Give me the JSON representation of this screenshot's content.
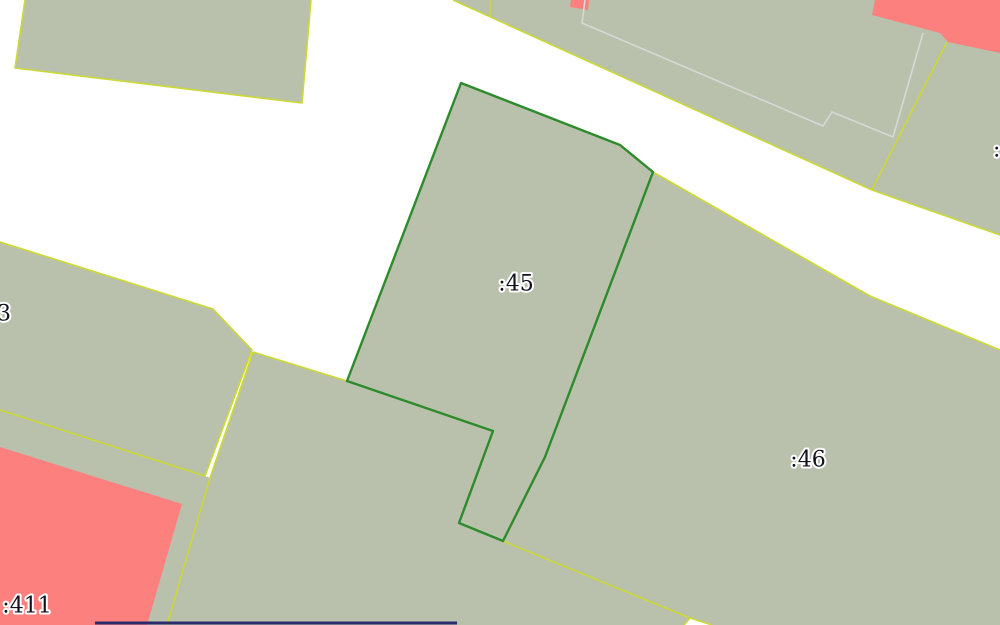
{
  "map": {
    "title": "cadastral-parcel-map",
    "colors": {
      "background": "#ffffff",
      "parcel_fill": "#b9c1ac",
      "boundary_yellow": "#ccd934",
      "selected_green": "#2e8b2c",
      "building_red": "#fc807e",
      "building_outline_gray": "#d8d8d6",
      "navy_line": "#2b2b6e",
      "label_text": "#12121c",
      "label_halo": "#ffffff"
    },
    "parcels": [
      {
        "id": "parcel-top-left",
        "points": "25,0 311,0 302,103 15,68"
      },
      {
        "id": "parcel-top-sliver",
        "points": "453,0 490,0 490,17"
      },
      {
        "id": "parcel-top-center",
        "points": "490,0 938,0 947,42 872,190 490,17"
      },
      {
        "id": "parcel-top-right",
        "points": "938,0 1000,0 1000,235 872,190 947,42"
      },
      {
        "id": "parcel-3",
        "points": "0,242 213,309 252,350 205,476 0,410"
      },
      {
        "id": "parcel-411",
        "points": "0,410 205,476 210,478 167,625 0,625"
      },
      {
        "id": "parcel-bottom-center",
        "points": "253,352 347,381 493,431 459,523 503,541 690,618 684,625 167,625 210,478"
      },
      {
        "id": "parcel-46",
        "points": "653,172 870,296 1000,350 1000,625 712,625 690,618 503,541 545,457"
      }
    ],
    "selected_parcel": {
      "id": "parcel-45",
      "points": "461,83 620,145 653,172 545,457 503,541 459,523 493,431 347,381",
      "stroke_width": 2.4
    },
    "boundaries": [
      {
        "id": "boundary-top-left-parcel",
        "points": "25,0 15,68 302,103 311,0"
      },
      {
        "id": "boundary-road-north-edge",
        "points": "453,0 872,190"
      },
      {
        "id": "boundary-top-sliver-east",
        "points": "490,0 490,17"
      },
      {
        "id": "boundary-center-vs-right",
        "points": "872,190 947,42"
      },
      {
        "id": "boundary-right-road-edge",
        "points": "872,190 1000,235"
      },
      {
        "id": "boundary-46-north",
        "points": "653,172 870,296 1000,350"
      },
      {
        "id": "boundary-parcel-3",
        "points": "0,242 213,309 252,350 205,476 0,410"
      },
      {
        "id": "boundary-bottom-center-west",
        "points": "253,352 210,478 167,625"
      },
      {
        "id": "boundary-road-end-south",
        "points": "253,352 347,381"
      },
      {
        "id": "boundary-46-southwest",
        "points": "503,541 690,618 684,625"
      },
      {
        "id": "boundary-fork-southeast",
        "points": "690,618 712,625"
      }
    ],
    "buildings": [
      {
        "id": "building-411",
        "points": "0,447 182,504 147,625 0,625"
      },
      {
        "id": "building-top-right",
        "points": "875,0 872,15 940,33 948,42 1000,53 1000,0"
      },
      {
        "id": "building-top-center",
        "points": "571,0 570,7 588,10 589,0"
      }
    ],
    "building_outlines": [
      {
        "id": "building-outline-stepped",
        "points": "585,0 582,23 823,126 832,112 893,137 923,33"
      }
    ],
    "extra_lines": [
      {
        "id": "navy-bottom-line",
        "points": "95,623 457,623",
        "width": 3
      }
    ],
    "labels": [
      {
        "id": "label-parcel-45",
        "text": ":45",
        "x": 516,
        "y": 284,
        "anchor": "middle"
      },
      {
        "id": "label-parcel-46",
        "text": ":46",
        "x": 808,
        "y": 460,
        "anchor": "middle"
      },
      {
        "id": "label-parcel-411",
        "text": ":411",
        "x": 27,
        "y": 606,
        "anchor": "middle"
      },
      {
        "id": "label-parcel-3-clipped",
        "text": ":3",
        "x": 11,
        "y": 314,
        "anchor": "end"
      },
      {
        "id": "label-right-edge-clipped",
        "text": ":",
        "x": 993,
        "y": 150,
        "anchor": "start"
      }
    ]
  }
}
